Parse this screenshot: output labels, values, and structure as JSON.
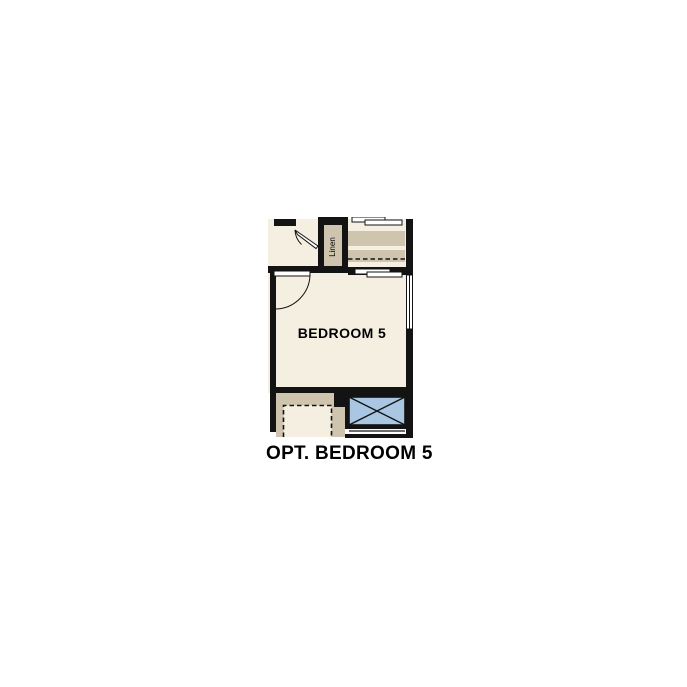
{
  "plan": {
    "caption": "OPT. BEDROOM 5",
    "bedroom_label": "BEDROOM 5",
    "linen_label": "Linen",
    "colors": {
      "wall": "#131313",
      "floor": "#f5efe1",
      "casework": "#cfc4ad",
      "shower_fill": "#a9c6e2",
      "page_bg": "#ffffff"
    }
  }
}
